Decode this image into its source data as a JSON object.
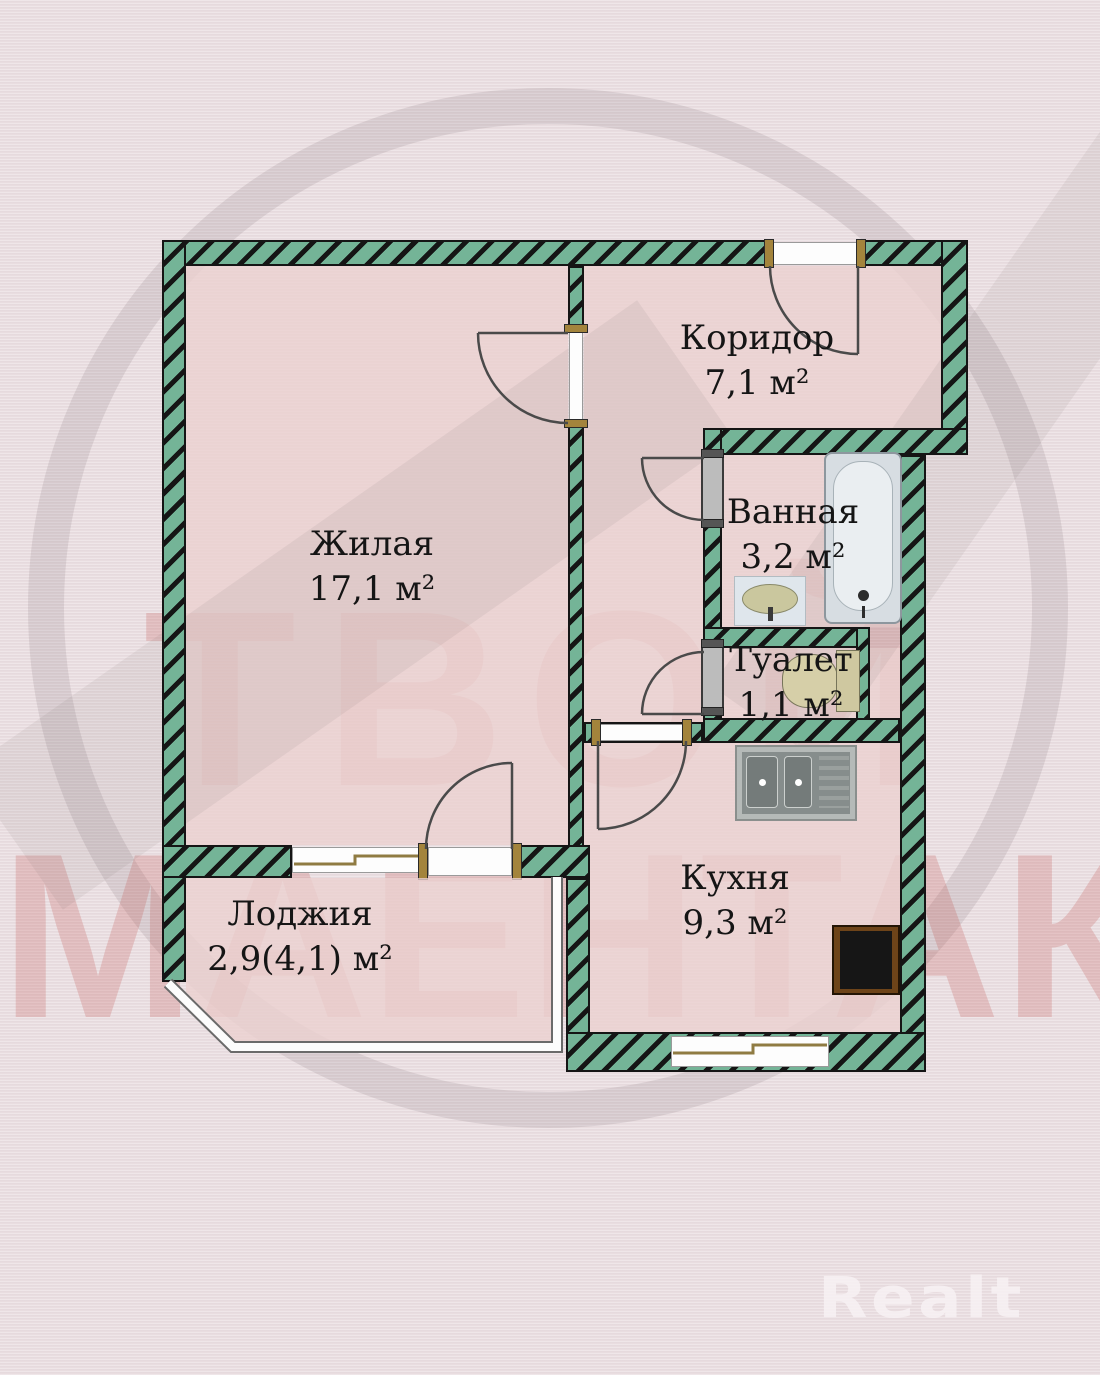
{
  "plan": {
    "rooms": {
      "living": {
        "name": "Жилая",
        "area": "17,1 м²"
      },
      "corridor": {
        "name": "Коридор",
        "area": "7,1 м²"
      },
      "bathroom": {
        "name": "Ванная",
        "area": "3,2 м²"
      },
      "toilet": {
        "name": "Туалет",
        "area": "1,1 м²"
      },
      "kitchen": {
        "name": "Кухня",
        "area": "9,3 м²"
      },
      "loggia": {
        "name": "Лоджия",
        "area": "2,9(4,1) м²"
      }
    },
    "colors": {
      "wall_hatch_green": "#74b497",
      "wall_hatch_black": "#151515",
      "room_fill": "#ebd1cf",
      "background": "#e9dde0",
      "watermark_red": "#be4b46",
      "fixture_beige": "#cfc8a0"
    }
  },
  "watermark": {
    "line1": "ТВОЙ",
    "line2": "МАЕНТАК"
  },
  "brand": {
    "logo": "Realt"
  }
}
